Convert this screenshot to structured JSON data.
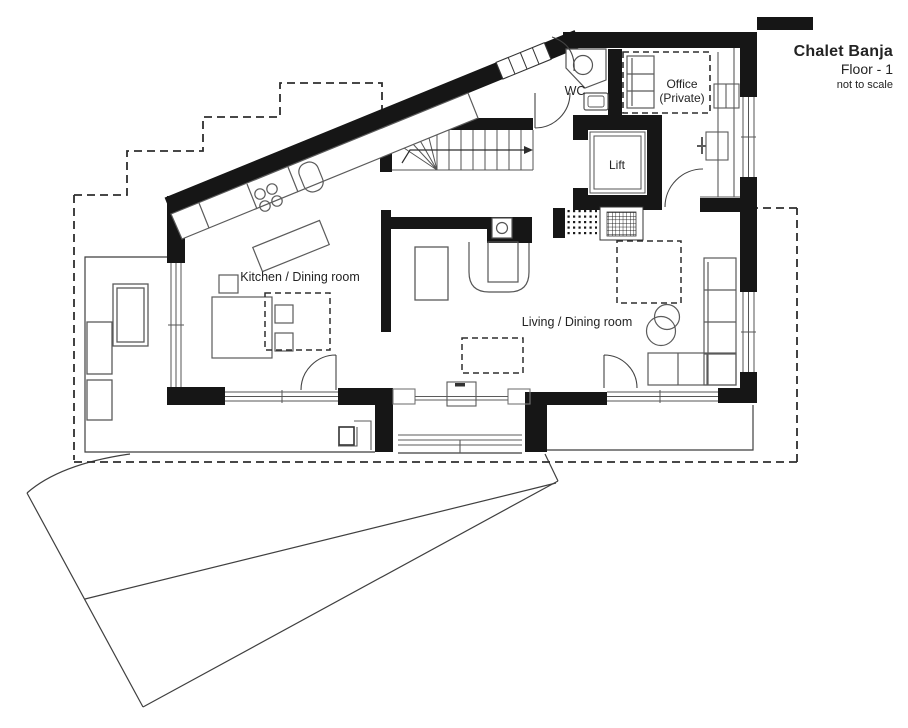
{
  "title_block": {
    "project": "Chalet Banja",
    "floor": "Floor - 1",
    "scale_note": "not to scale"
  },
  "rooms": {
    "wc": "WC",
    "office_line1": "Office",
    "office_line2": "(Private)",
    "lift": "Lift",
    "kitchen": "Kitchen / Dining room",
    "living": "Living / Dining room"
  },
  "colors": {
    "wall_ink": "#161616",
    "line_ink": "#555555",
    "paper": "#ffffff"
  }
}
